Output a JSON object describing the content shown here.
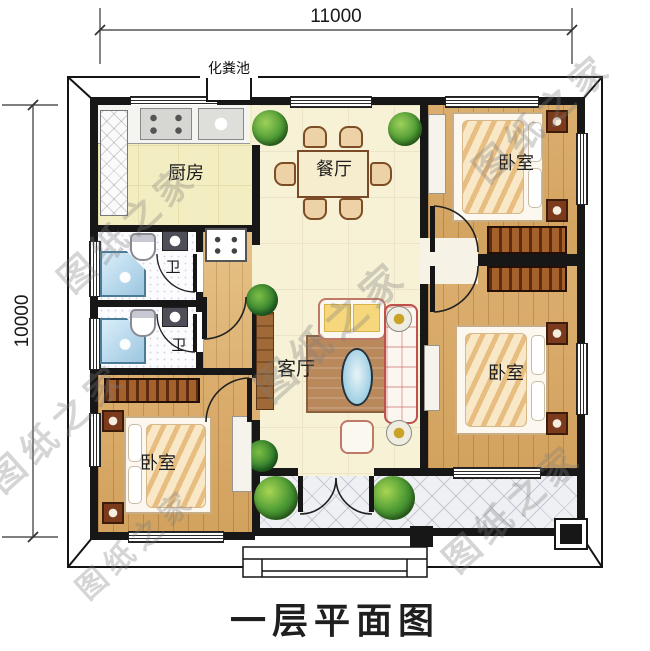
{
  "title": "一层平面图",
  "dimensions": {
    "width_label": "11000",
    "height_label": "10000"
  },
  "annotations": {
    "septic_tank": "化粪池"
  },
  "rooms": {
    "kitchen": {
      "label": "厨房"
    },
    "dining": {
      "label": "餐厅"
    },
    "living": {
      "label": "客厅"
    },
    "bedroom_top_right": {
      "label": "卧室"
    },
    "bedroom_bottom_right": {
      "label": "卧室"
    },
    "bedroom_bottom_left": {
      "label": "卧室"
    },
    "bath_upper": {
      "label": "卫"
    },
    "bath_lower": {
      "label": "卫"
    }
  },
  "watermark": {
    "text": "图纸之家"
  },
  "colors": {
    "wall": "#171717",
    "wood_floor": "#d8a766",
    "cream_floor": "#f7f1d6",
    "kitchen_floor": "#f3edc2",
    "porch_tile": "#eef0f4",
    "coffee_table_blue": "#aad4e4",
    "plant_green": "#4c9a34",
    "wardrobe_brown": "#a5612b",
    "sofa_accent_red": "#c0504a"
  }
}
